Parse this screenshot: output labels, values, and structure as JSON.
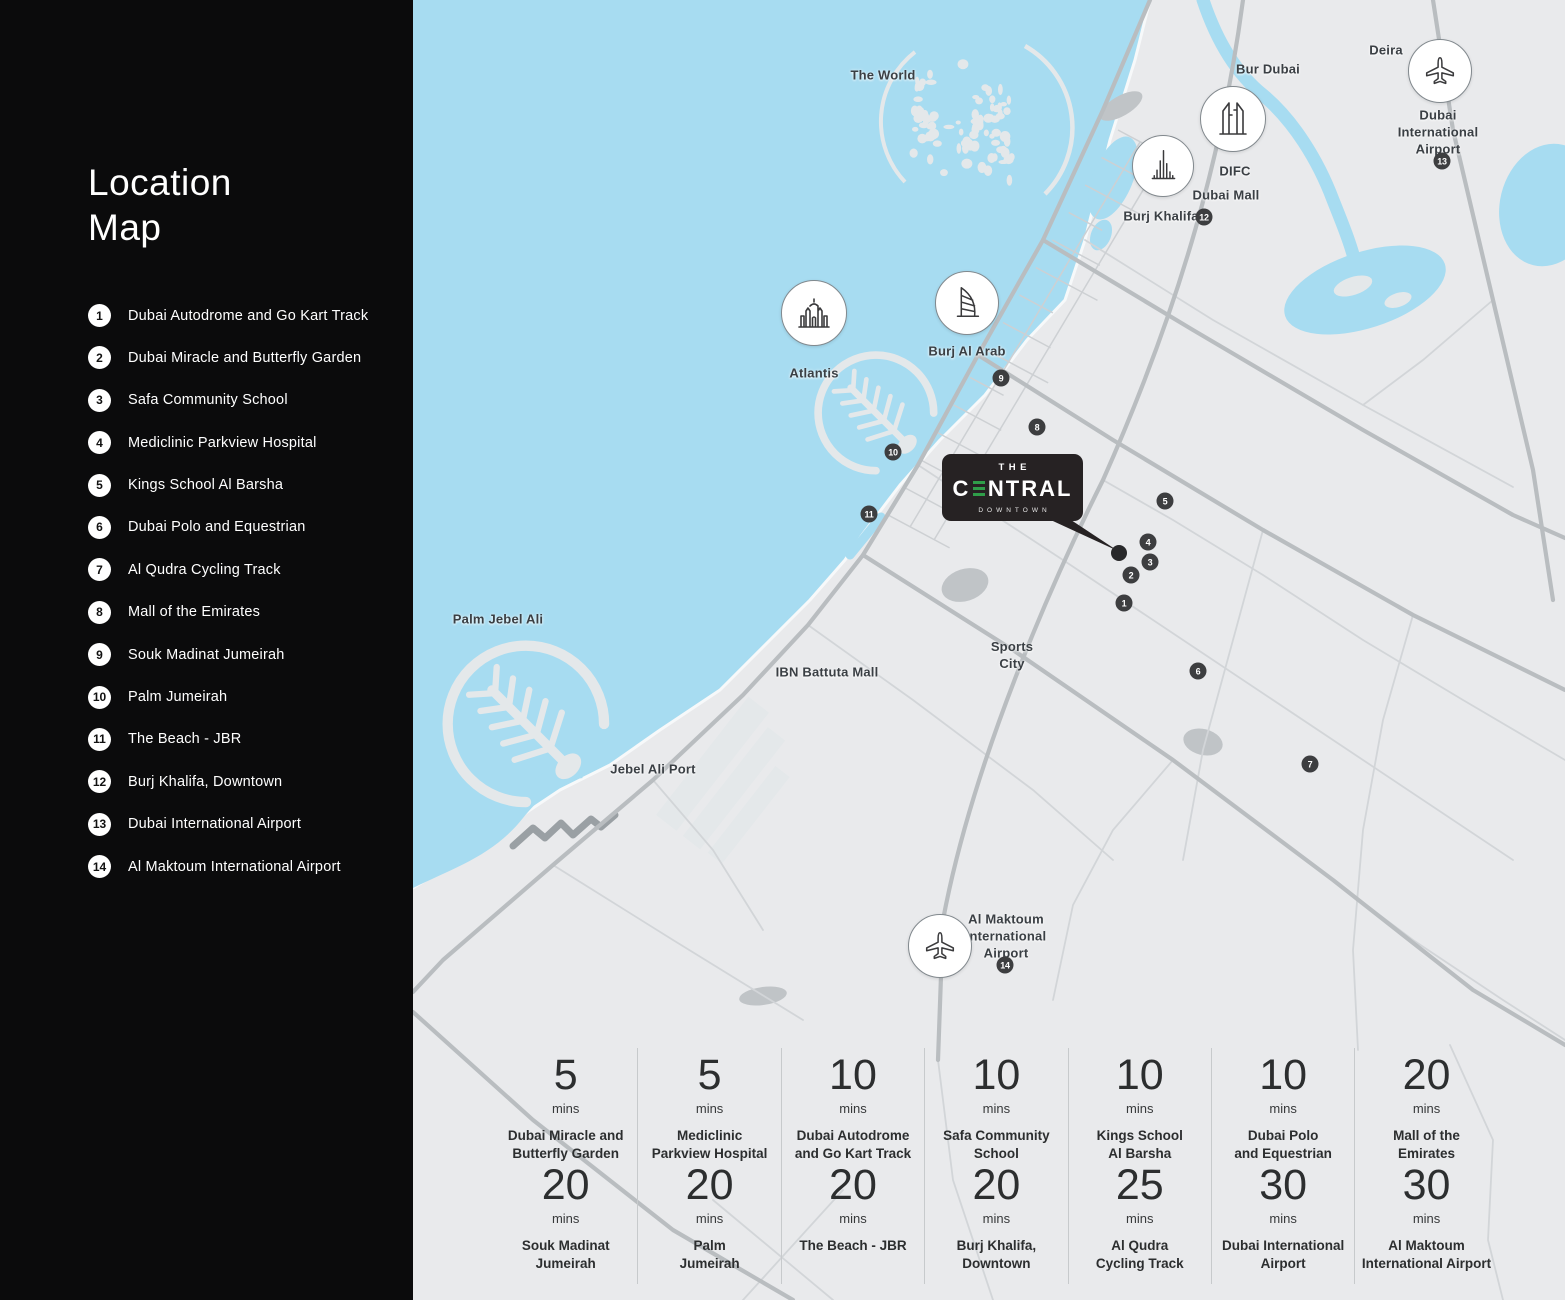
{
  "sidebar": {
    "title": "Location\nMap",
    "items": [
      {
        "n": "1",
        "label": "Dubai Autodrome and Go Kart Track"
      },
      {
        "n": "2",
        "label": "Dubai Miracle and Butterfly Garden"
      },
      {
        "n": "3",
        "label": "Safa Community School"
      },
      {
        "n": "4",
        "label": "Mediclinic Parkview Hospital"
      },
      {
        "n": "5",
        "label": "Kings School Al Barsha"
      },
      {
        "n": "6",
        "label": "Dubai Polo and Equestrian"
      },
      {
        "n": "7",
        "label": "Al Qudra Cycling Track"
      },
      {
        "n": "8",
        "label": "Mall of the Emirates"
      },
      {
        "n": "9",
        "label": "Souk Madinat Jumeirah"
      },
      {
        "n": "10",
        "label": "Palm Jumeirah"
      },
      {
        "n": "11",
        "label": "The Beach - JBR"
      },
      {
        "n": "12",
        "label": "Burj Khalifa, Downtown"
      },
      {
        "n": "13",
        "label": "Dubai International Airport"
      },
      {
        "n": "14",
        "label": "Al Maktoum International Airport"
      }
    ]
  },
  "map": {
    "colors": {
      "water": "#a7dcf1",
      "land": "#e9eaec",
      "island": "#e4e8ea",
      "road": "#b9bdc0",
      "road_minor": "#d2d5d8",
      "marker_bg": "#3d3e40",
      "callout_bg": "#262223",
      "accent_green": "#2f9e49",
      "dock": "#9aa0a4",
      "park": "#c0c4c7"
    },
    "labels": [
      {
        "text": "The World",
        "x": 470,
        "y": 76
      },
      {
        "text": "Deira",
        "x": 973,
        "y": 51
      },
      {
        "text": "Bur Dubai",
        "x": 855,
        "y": 70
      },
      {
        "text": "DIFC",
        "x": 822,
        "y": 172
      },
      {
        "text": "Dubai Mall",
        "x": 813,
        "y": 196
      },
      {
        "text": "Burj Khalifa",
        "x": 748,
        "y": 217
      },
      {
        "text": "Dubai\nInternational\nAirport",
        "x": 1025,
        "y": 133
      },
      {
        "text": "Atlantis",
        "x": 401,
        "y": 374
      },
      {
        "text": "Burj Al Arab",
        "x": 554,
        "y": 352
      },
      {
        "text": "Palm Jebel Ali",
        "x": 85,
        "y": 620
      },
      {
        "text": "IBN Battuta Mall",
        "x": 414,
        "y": 673
      },
      {
        "text": "Jebel Ali Port",
        "x": 240,
        "y": 770
      },
      {
        "text": "Sports\nCity",
        "x": 599,
        "y": 656
      },
      {
        "text": "Al Maktoum\nInternational\nAirport",
        "x": 593,
        "y": 937
      }
    ],
    "markers": [
      {
        "n": "1",
        "x": 711,
        "y": 603
      },
      {
        "n": "2",
        "x": 718,
        "y": 575
      },
      {
        "n": "3",
        "x": 737,
        "y": 562
      },
      {
        "n": "4",
        "x": 735,
        "y": 542
      },
      {
        "n": "5",
        "x": 752,
        "y": 501
      },
      {
        "n": "6",
        "x": 785,
        "y": 671
      },
      {
        "n": "7",
        "x": 897,
        "y": 764
      },
      {
        "n": "8",
        "x": 624,
        "y": 427
      },
      {
        "n": "9",
        "x": 588,
        "y": 378
      },
      {
        "n": "10",
        "x": 480,
        "y": 452
      },
      {
        "n": "11",
        "x": 456,
        "y": 514
      },
      {
        "n": "12",
        "x": 791,
        "y": 217
      },
      {
        "n": "13",
        "x": 1029,
        "y": 161
      },
      {
        "n": "14",
        "x": 592,
        "y": 965
      }
    ],
    "pois": [
      {
        "icon": "burj-khalifa-tower",
        "x": 750,
        "y": 166,
        "d": 60
      },
      {
        "icon": "difc-towers",
        "x": 820,
        "y": 119,
        "d": 64
      },
      {
        "icon": "airplane",
        "x": 1027,
        "y": 71,
        "d": 62
      },
      {
        "icon": "atlantis-palace",
        "x": 401,
        "y": 313,
        "d": 64
      },
      {
        "icon": "burj-al-arab-sail",
        "x": 554,
        "y": 303,
        "d": 62
      },
      {
        "icon": "airplane",
        "x": 527,
        "y": 946,
        "d": 62
      }
    ],
    "callout": {
      "top": "THE",
      "name": "CENTRAL",
      "sub": "DOWNTOWN"
    }
  },
  "times": {
    "unit": "mins",
    "rows": [
      [
        {
          "value": "5",
          "label": "Dubai Miracle and\nButterfly Garden"
        },
        {
          "value": "5",
          "label": "Mediclinic\nParkview Hospital"
        },
        {
          "value": "10",
          "label": "Dubai Autodrome\nand Go Kart Track"
        },
        {
          "value": "10",
          "label": "Safa Community\nSchool"
        },
        {
          "value": "10",
          "label": "Kings School\nAl Barsha"
        },
        {
          "value": "10",
          "label": "Dubai Polo\nand Equestrian"
        },
        {
          "value": "20",
          "label": "Mall of the\nEmirates"
        }
      ],
      [
        {
          "value": "20",
          "label": "Souk Madinat\nJumeirah"
        },
        {
          "value": "20",
          "label": "Palm\nJumeirah"
        },
        {
          "value": "20",
          "label": "The Beach - JBR"
        },
        {
          "value": "20",
          "label": "Burj Khalifa,\nDowntown"
        },
        {
          "value": "25",
          "label": "Al Qudra\nCycling Track"
        },
        {
          "value": "30",
          "label": "Dubai International\nAirport"
        },
        {
          "value": "30",
          "label": "Al Maktoum\nInternational Airport"
        }
      ]
    ]
  }
}
